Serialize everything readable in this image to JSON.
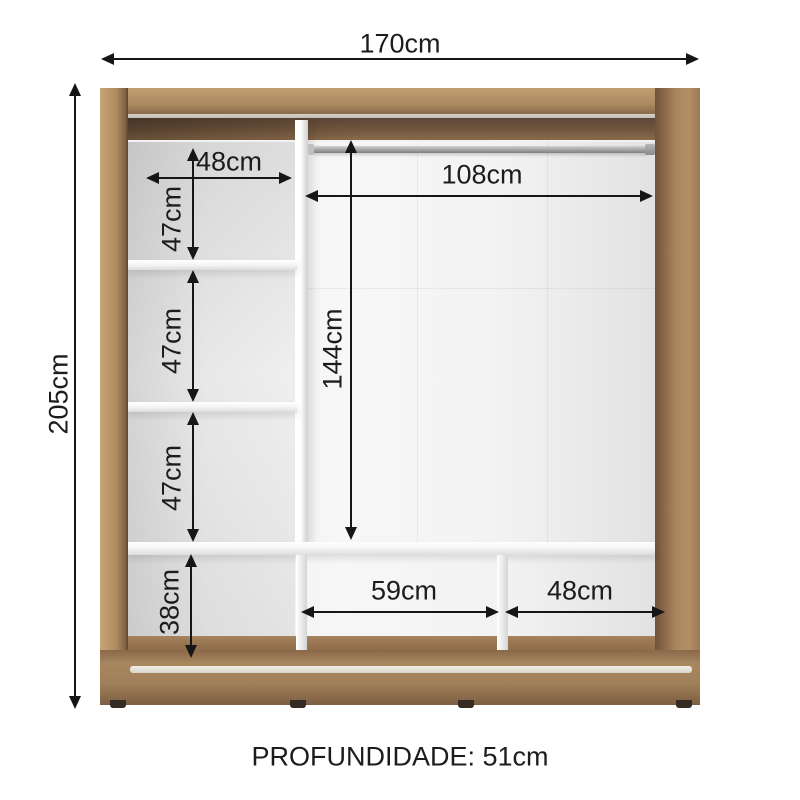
{
  "dimensions": {
    "total_width": "170cm",
    "total_height": "205cm",
    "shelf_column_width": "48cm",
    "shelf_cell_1_height": "47cm",
    "shelf_cell_2_height": "47cm",
    "shelf_cell_3_height": "47cm",
    "shelf_cell_4_height": "38cm",
    "hanging_section_width": "108cm",
    "hanging_section_height": "144cm",
    "bottom_middle_width": "59cm",
    "bottom_right_width": "48cm"
  },
  "footer": {
    "depth_label": "PROFUNDIDADE: 51cm"
  },
  "colors": {
    "wood": "#ab885f",
    "wood_dark": "#6e5339",
    "interior_white": "#f3f3f3",
    "shelf_white": "#ffffff",
    "dimension_line": "#161616",
    "rod_gray": "#a8a8a8",
    "background": "#ffffff"
  }
}
